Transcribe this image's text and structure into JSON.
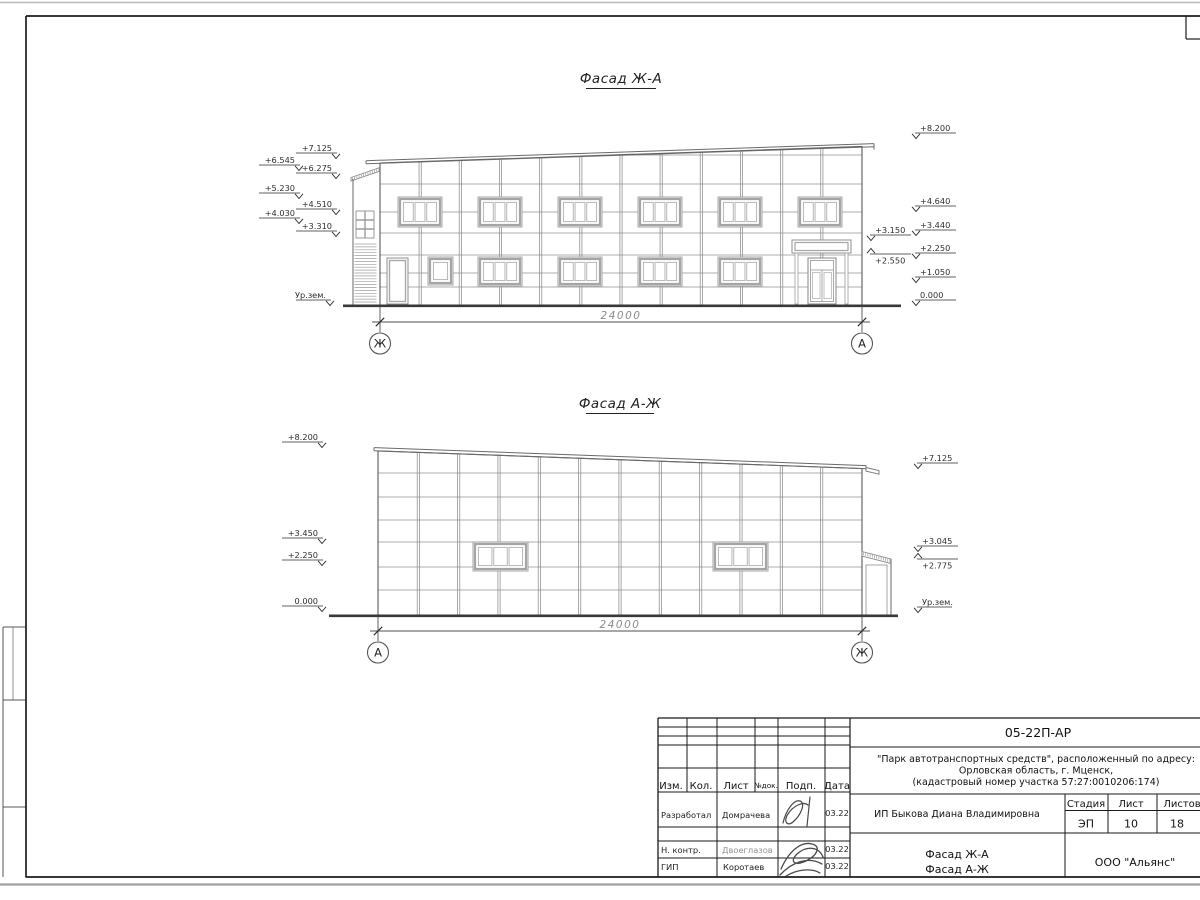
{
  "sheet": {
    "facades": [
      {
        "title": "Фасад Ж-А",
        "dimension": "24000",
        "axis_left": "Ж",
        "axis_right": "А",
        "marks_left": [
          "+7.125",
          "+6.545",
          "+6.275",
          "+5.230",
          "+4.510",
          "+4.030",
          "+3.310",
          "Ур.зем."
        ],
        "marks_right_near": [
          "+3.150",
          "+2.550"
        ],
        "marks_right": [
          "+8.200",
          "+4.640",
          "+3.440",
          "+2.250",
          "+1.050",
          "0.000"
        ]
      },
      {
        "title": "Фасад А-Ж",
        "dimension": "24000",
        "axis_left": "А",
        "axis_right": "Ж",
        "marks_left": [
          "+8.200",
          "+3.450",
          "+2.250",
          "0.000"
        ],
        "marks_right": [
          "+7.125",
          "+3.045",
          "+2.775",
          "Ур.зем."
        ]
      }
    ],
    "title_block": {
      "doc_number": "05-22П-АР",
      "project_line1": "\"Парк автотранспортных средств\",  расположенный по адресу:",
      "project_line2": "Орловская область, г. Мценск,",
      "project_line3": "(кадастровый номер участка 57:27:0010206:174)",
      "client": "ИП Быкова Диана Владимировна",
      "sheet_title_line1": "Фасад Ж-А",
      "sheet_title_line2": "Фасад А-Ж",
      "organization": "ООО \"Альянс\"",
      "headers": {
        "izm": "Изм.",
        "kol": "Кол.",
        "list": "Лист",
        "doc": "№док.",
        "podp": "Подп.",
        "data": "Дата",
        "stage": "Стадия",
        "sheet": "Лист",
        "sheets": "Листов"
      },
      "stage": "ЭП",
      "sheet_no": "10",
      "sheets_total": "18",
      "roles": [
        {
          "role": "Разработал",
          "name": "Домрачева",
          "date": "03.22"
        },
        {
          "role": "Н. контр.",
          "name": "Двоеглазов",
          "date": "03.22"
        },
        {
          "role": "ГИП",
          "name": "Коротаев",
          "date": "03.22"
        }
      ]
    }
  }
}
